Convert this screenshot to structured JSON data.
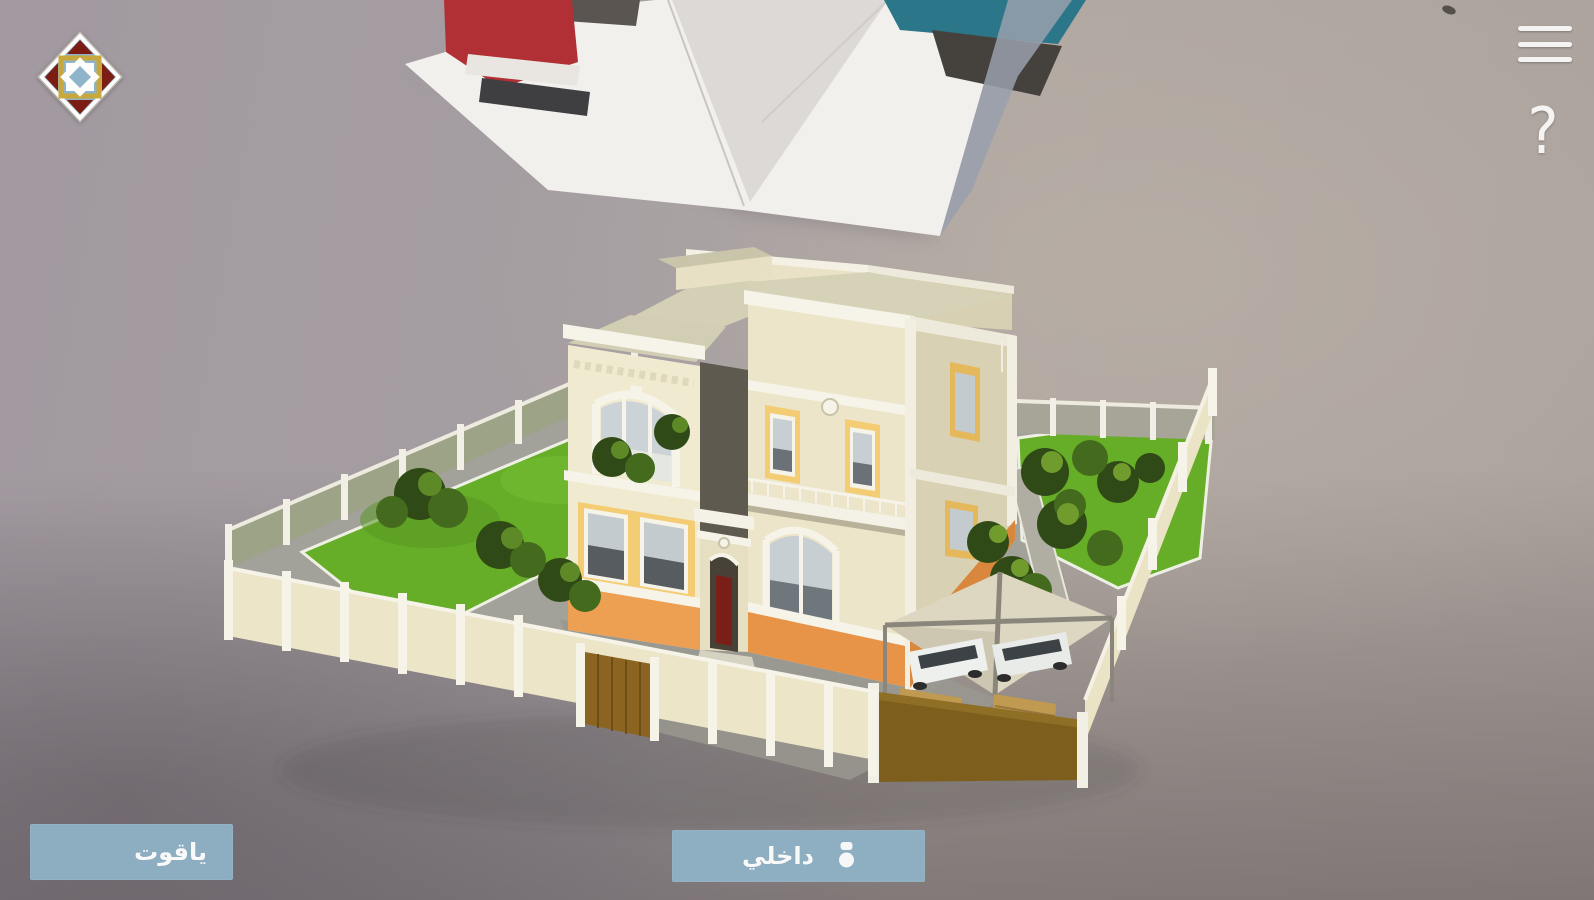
{
  "header": {
    "logo_icon": "geometric-tile-logo",
    "menu_icon": "hamburger-menu-icon",
    "help_label": "?"
  },
  "ar_scene": {
    "model_icon": "villa-3d-model",
    "background_icon": "camera-passthrough-room-wall-with-shelf"
  },
  "footer": {
    "model_name_label": "ياقوت",
    "interior_label": "داخلي",
    "interior_icon": "person-pin-icon"
  },
  "colors": {
    "button_bg": "#8FB1C5",
    "button_text": "#FFFFFF",
    "icon_white": "#F5F4F2",
    "logo_red": "#7C1D13",
    "logo_blue": "#8FB3C9",
    "logo_gold": "#C8A83C",
    "house_cream": "#ECE5C9",
    "house_trim": "#F6F3E8",
    "accent_yellow": "#F3CC74",
    "accent_orange": "#E89448",
    "lawn_green": "#66AD28",
    "fence_cream": "#EAE3C6",
    "carport_wall_brown": "#7D5E1D"
  }
}
